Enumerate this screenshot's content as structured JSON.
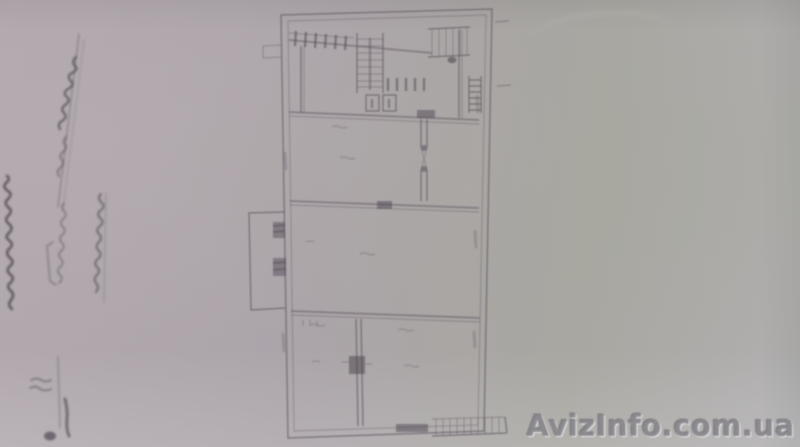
{
  "watermark": {
    "text": "AvizInfo.com.ua",
    "color": "#88868c",
    "highlight": "#f0eff2",
    "shadow": "#4e4c52"
  },
  "palette": {
    "paper_left": "#b2a9ae",
    "paper_center": "#aba4a9",
    "paper_right": "#a8a7a1",
    "paper_bottom": "#b2b0b2",
    "ink": "#675e68",
    "ink_dark": "#4f4851"
  }
}
